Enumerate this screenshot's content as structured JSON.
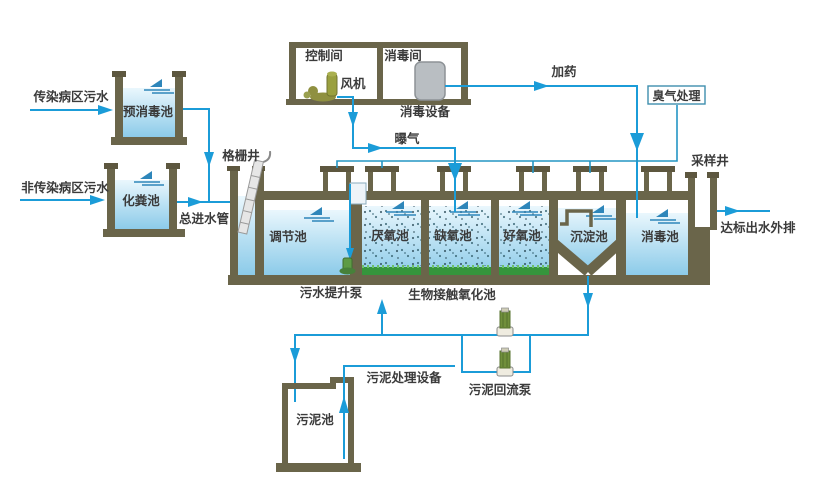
{
  "colors": {
    "pipe_blue": "#1b9cd8",
    "wall_olive": "#6a654a",
    "wall_dark": "#5d573f",
    "water_light": "#e9f6fc",
    "water_deep": "#8ccbe9",
    "media_green": "#35953c",
    "pump_green": "#708f3b",
    "equipment_gray": "#b9bec2",
    "text": "#3b3b3b"
  },
  "sources": {
    "infectious": "传染病区污水",
    "non_infectious": "非传染病区污水"
  },
  "pretreatment": {
    "pre_disinfection_tank": "预消毒池",
    "septic_tank": "化粪池",
    "main_inlet_pipe": "总进水管",
    "screen_well": "格栅井"
  },
  "building": {
    "control_room": "控制间",
    "fan": "风机",
    "disinfection_room": "消毒间",
    "disinfection_equipment": "消毒设备",
    "dosing_line": "加药",
    "aeration_line": "曝气"
  },
  "odor_treatment": {
    "label": "臭气处理"
  },
  "process_tanks": {
    "regulating_tank": "调节池",
    "anaerobic_tank": "厌氧池",
    "anoxic_tank": "缺氧池",
    "aerobic_tank": "好氧池",
    "sedimentation_tank": "沉淀池",
    "disinfection_tank": "消毒池",
    "lift_pump": "污水提升泵",
    "bio_contact_oxidation_tank": "生物接触氧化池"
  },
  "effluent": {
    "sampling_well": "采样井",
    "outfall": "达标出水外排"
  },
  "sludge": {
    "sludge_tank": "污泥池",
    "sludge_treatment_equipment": "污泥处理设备",
    "sludge_return_pump": "污泥回流泵"
  }
}
